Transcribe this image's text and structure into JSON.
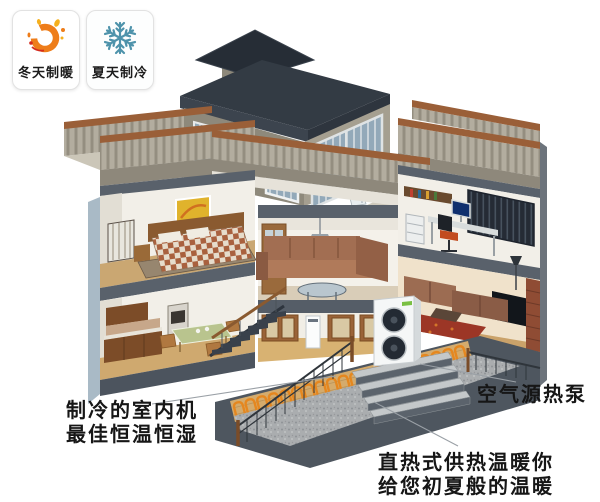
{
  "canvas": {
    "width": 600,
    "height": 502,
    "background": "#ffffff"
  },
  "badges": [
    {
      "label": "冬天制暖",
      "icon": "sun-swirl-icon",
      "primary_color": "#ee7d1a",
      "secondary_color": "#f5b01e",
      "tertiary_color": "#d42b1e"
    },
    {
      "label": "夏天制冷",
      "icon": "snowflake-icon",
      "primary_color": "#4e93ab"
    }
  ],
  "callouts": {
    "indoor_unit": {
      "line1": "制冷的室内机",
      "line2": "最佳恒温恒湿",
      "text_color": "#161616"
    },
    "heat_pump": {
      "text": "空气源热泵",
      "text_color": "#161616"
    },
    "direct_heating": {
      "line1": "直热式供热温暖你",
      "line2": "给您初夏般的温暖",
      "text_color": "#161616"
    }
  },
  "scene": {
    "heating_coil_color": "#e5871f",
    "roof_color": "#333b44",
    "terrace_coping_color": "#9a5f38",
    "wall_color": "#f2efe8",
    "heat_pump_body_color": "#f5f7f7",
    "heat_pump_fan_color": "#232a33",
    "leader_line_color": "#9aa0a6"
  }
}
